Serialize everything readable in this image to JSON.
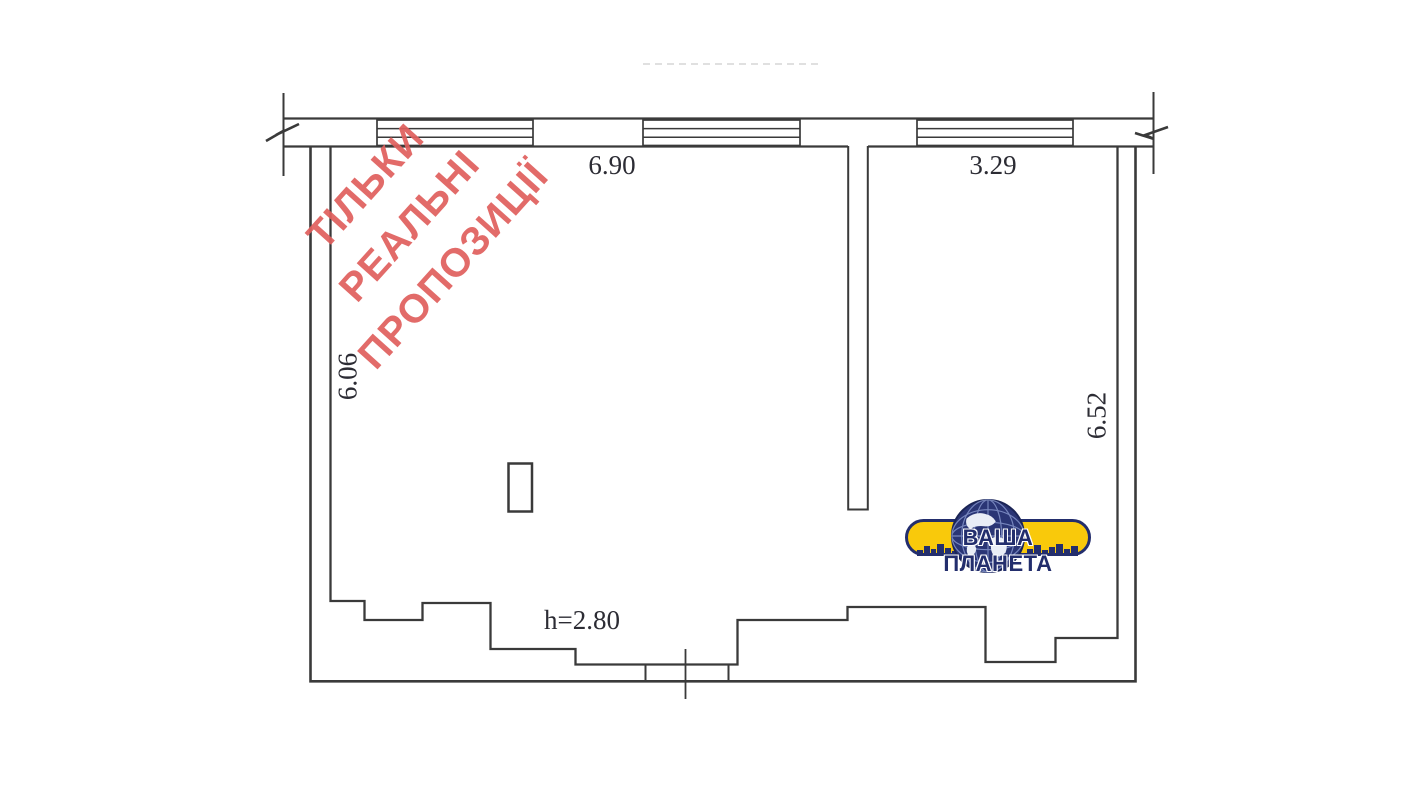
{
  "watermark": {
    "lines": [
      "ТІЛЬКИ",
      "РЕАЛЬНІ",
      "ПРОПОЗИЦІЇ"
    ]
  },
  "dimensions": {
    "room_left_width": "6.90",
    "room_right_width": "3.29",
    "left_height": "6.06",
    "right_height": "6.52",
    "ceiling_height": "h=2.80"
  },
  "logo": {
    "name": "ВАША ПЛАНЕТА"
  },
  "colors": {
    "line-color": "#3a3a3a",
    "dim-text": "#2c2c34",
    "watermark-red": "#e05f5d",
    "logo-yellow": "#f9c90b",
    "logo-navy": "#232e6d"
  }
}
